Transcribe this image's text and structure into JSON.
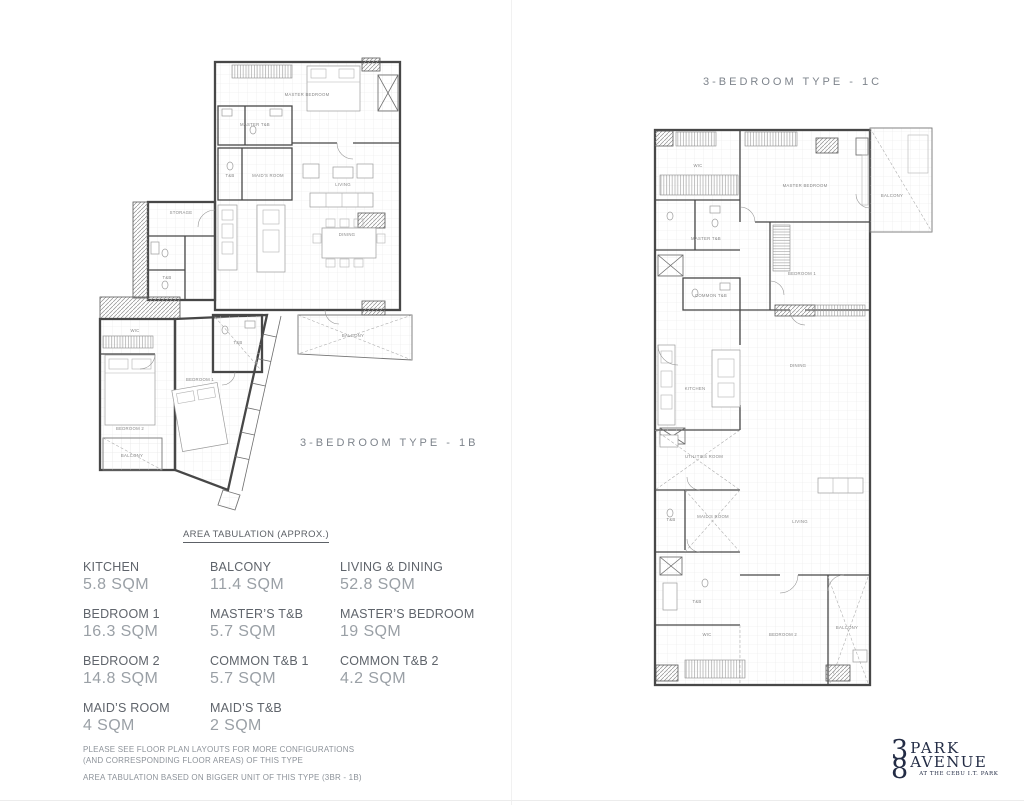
{
  "colors": {
    "logo_navy": "#232c45",
    "tab_label_gray": "#5f646b",
    "tab_value_gray": "#9aa0a6",
    "plan_line_gray": "#474747"
  },
  "plans": {
    "left": {
      "title": "3-BEDROOM TYPE - 1B",
      "rooms": [
        {
          "label": "MASTER BEDROOM"
        },
        {
          "label": "MASTER T&B"
        },
        {
          "label": "T&B"
        },
        {
          "label": "MAID'S ROOM"
        },
        {
          "label": "LIVING"
        },
        {
          "label": "DINING"
        },
        {
          "label": "STORAGE"
        },
        {
          "label": "T&B"
        },
        {
          "label": "WIC"
        },
        {
          "label": "BEDROOM 2"
        },
        {
          "label": "BEDROOM 1"
        },
        {
          "label": "T&B"
        },
        {
          "label": "BALCONY"
        },
        {
          "label": "BALCONY"
        }
      ]
    },
    "right": {
      "title": "3-BEDROOM TYPE - 1C",
      "rooms": [
        {
          "label": "WIC"
        },
        {
          "label": "MASTER BEDROOM"
        },
        {
          "label": "BALCONY"
        },
        {
          "label": "MASTER T&B"
        },
        {
          "label": "COMMON T&B"
        },
        {
          "label": "BEDROOM 1"
        },
        {
          "label": "KITCHEN"
        },
        {
          "label": "DINING"
        },
        {
          "label": "UTILITIES ROOM"
        },
        {
          "label": "MAID'S ROOM"
        },
        {
          "label": "T&B"
        },
        {
          "label": "T&B"
        },
        {
          "label": "LIVING"
        },
        {
          "label": "WIC"
        },
        {
          "label": "BEDROOM 2"
        },
        {
          "label": "BALCONY"
        }
      ]
    }
  },
  "tabulation": {
    "heading": "AREA TABULATION (APPROX.)",
    "entries": [
      {
        "label": "KITCHEN",
        "value": "5.8 SQM"
      },
      {
        "label": "BALCONY",
        "value": "11.4 SQM"
      },
      {
        "label": "LIVING & DINING",
        "value": "52.8 SQM"
      },
      {
        "label": "BEDROOM 1",
        "value": "16.3 SQM"
      },
      {
        "label": "MASTER’S T&B",
        "value": "5.7 SQM"
      },
      {
        "label": "MASTER’S BEDROOM",
        "value": "19 SQM"
      },
      {
        "label": "BEDROOM 2",
        "value": "14.8 SQM"
      },
      {
        "label": "COMMON T&B 1",
        "value": "5.7 SQM"
      },
      {
        "label": "COMMON T&B 2",
        "value": "4.2 SQM"
      },
      {
        "label": "MAID’S ROOM",
        "value": "4 SQM"
      },
      {
        "label": "MAID’S T&B",
        "value": "2 SQM"
      }
    ]
  },
  "notes": {
    "line1": "PLEASE SEE FLOOR PLAN LAYOUTS FOR MORE CONFIGURATIONS",
    "line2": "(AND CORRESPONDING FLOOR AREAS) OF THIS TYPE",
    "line3": "AREA TABULATION BASED ON BIGGER UNIT OF THIS TYPE (3BR - 1B)"
  },
  "logo": {
    "digit_top": "3",
    "digit_bottom": "8",
    "word_top": "PARK",
    "word_bottom": "AVENUE",
    "tagline": "AT THE CEBU I.T. PARK"
  }
}
